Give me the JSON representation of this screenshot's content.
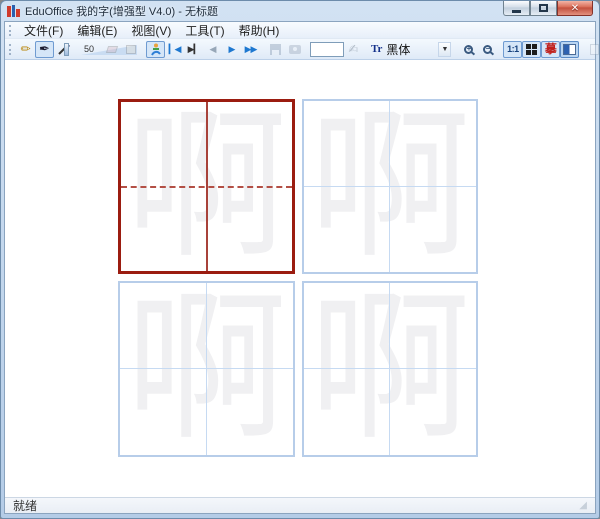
{
  "window": {
    "title": "EduOffice 我的字(增强型 V4.0) - 无标题",
    "close_glyph": "✕"
  },
  "menu": {
    "items": [
      {
        "label": "文件(F)"
      },
      {
        "label": "编辑(E)"
      },
      {
        "label": "视图(V)"
      },
      {
        "label": "工具(T)"
      },
      {
        "label": "帮助(H)"
      }
    ]
  },
  "toolbar": {
    "pencil_glyph": "✏",
    "pen_glyph": "✒",
    "stroke_width_value": "50",
    "write_hand_glyph": "✍",
    "playback": {
      "go_start": "▎◀",
      "go_end": "▶▎",
      "prev_stroke": "◀",
      "play": "▶",
      "fast_forward": "▶▶"
    },
    "char_input": {
      "value": ""
    },
    "font_selector": {
      "type_icon": "Tr",
      "value": "黑体",
      "arrow": "▼"
    },
    "zoom_in_sign": "+",
    "zoom_out_sign": "−",
    "actual_size_label": "1:1",
    "trace_label": "摹",
    "text_label": "A",
    "word_label": "W"
  },
  "grids": [
    {
      "character": "啊",
      "state": "active"
    },
    {
      "character": "啊",
      "state": "normal"
    },
    {
      "character": "啊",
      "state": "normal"
    },
    {
      "character": "啊",
      "state": "normal"
    }
  ],
  "status_bar": {
    "text": "就绪"
  },
  "colors": {
    "active_grid_border": "#9b1c10",
    "grid_border": "#b7cde9",
    "red_guide_line": "#a8423a",
    "blue_guide_line": "#c6daf2",
    "template_character": "#f0f0f2",
    "toolbar_selection": "#d5e6f8",
    "close_button": "#c04b38"
  }
}
